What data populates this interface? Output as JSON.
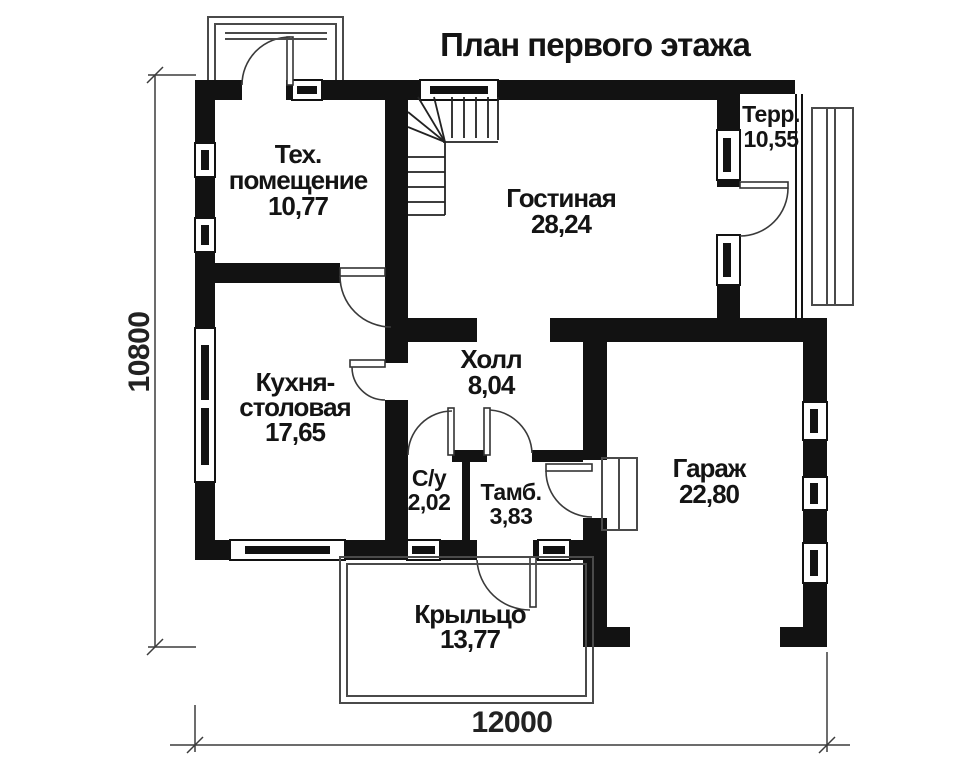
{
  "title": "План первого этажа",
  "rooms": {
    "tech": {
      "name_line1": "Тех.",
      "name_line2": "помещение",
      "area": "10,77"
    },
    "living": {
      "name": "Гостиная",
      "area": "28,24"
    },
    "terrace": {
      "name": "Терр.",
      "area": "10,55"
    },
    "kitchen": {
      "name_line1": "Кухня-",
      "name_line2": "столовая",
      "area": "17,65"
    },
    "hall": {
      "name": "Холл",
      "area": "8,04"
    },
    "wc": {
      "name": "С/у",
      "area": "2,02"
    },
    "vestibule": {
      "name": "Тамб.",
      "area": "3,83"
    },
    "garage": {
      "name": "Гараж",
      "area": "22,80"
    },
    "porch": {
      "name": "Крыльцо",
      "area": "13,77"
    }
  },
  "dimensions": {
    "horizontal": "12000",
    "vertical": "10800"
  },
  "colors": {
    "ink": "#121212",
    "background": "#ffffff"
  }
}
